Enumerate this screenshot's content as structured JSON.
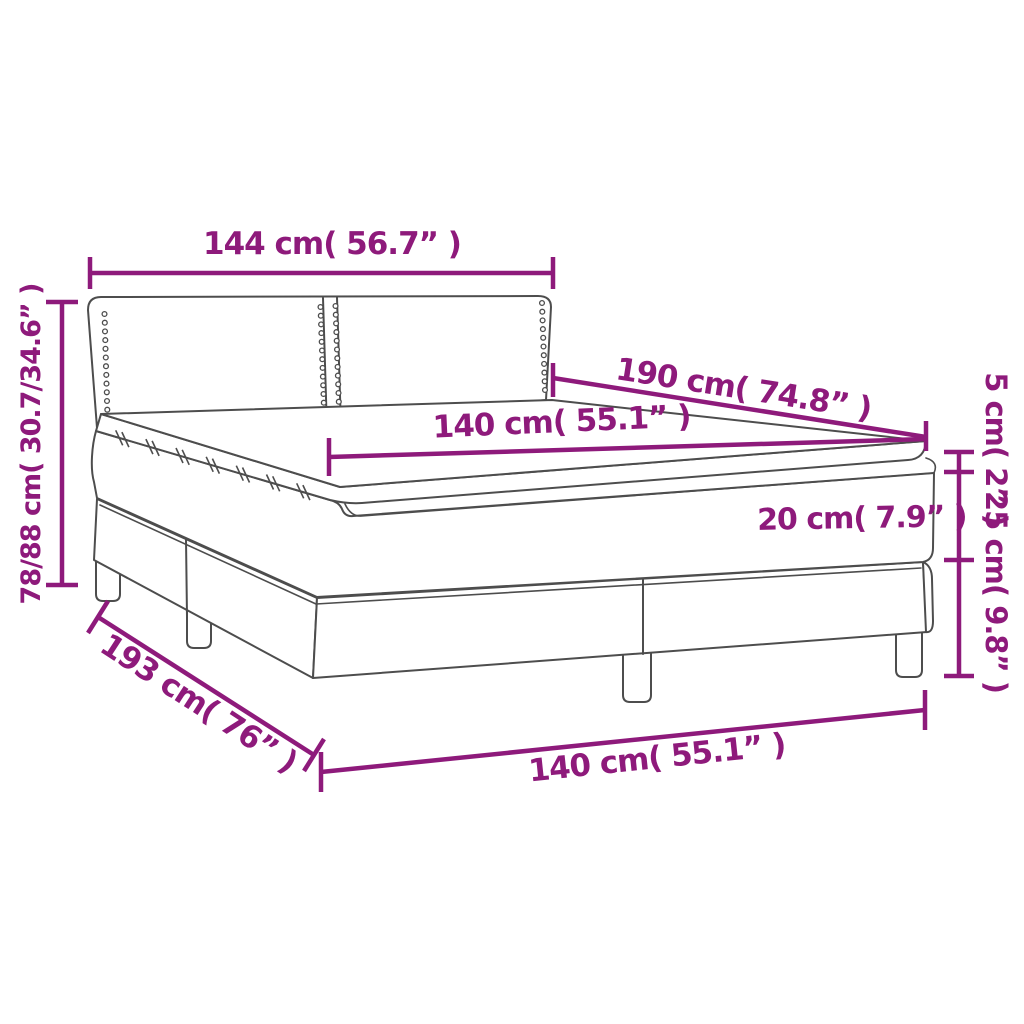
{
  "diagram": {
    "subject": "box-spring-bed-with-topper",
    "dimensions": {
      "headboard_width": "144 cm( 56.7” )",
      "total_height": "78/88 cm( 30.7/34.6” )",
      "mattress_length": "190 cm( 74.8” )",
      "mattress_width_top": "140 cm( 55.1” )",
      "topper_thickness": "5 cm( 2” )",
      "mattress_thickness": "20 cm( 7.9” )",
      "base_height": "25 cm( 9.8” )",
      "base_length": "193 cm( 76” )",
      "base_width_bottom": "140 cm( 55.1” )"
    },
    "colors": {
      "dimension_accent": "#8e1a7b",
      "drawing_outline": "#4d4d4d",
      "background": "#ffffff"
    }
  }
}
